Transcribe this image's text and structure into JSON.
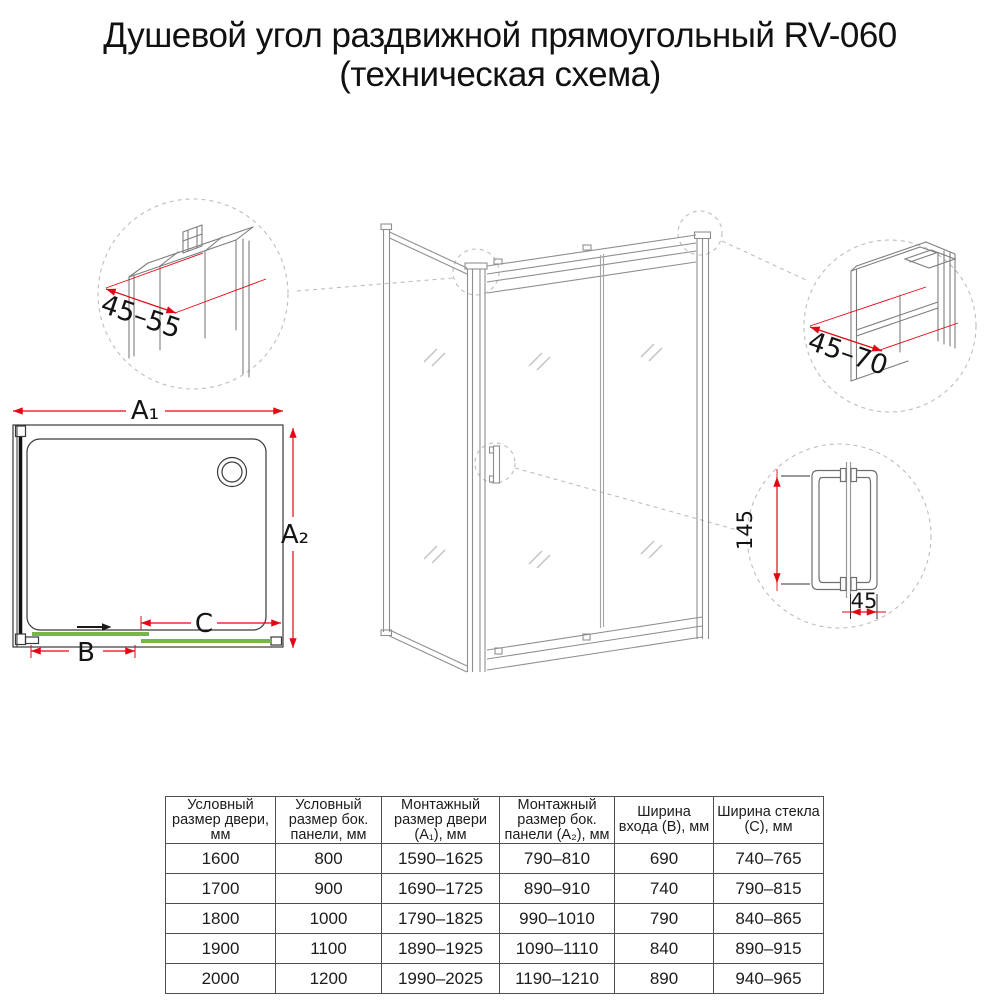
{
  "title": {
    "line1": "Душевой угол раздвижной прямоугольный RV-060",
    "line2": "(техническая схема)"
  },
  "diagram": {
    "plan_view": {
      "width_label": "A₁",
      "depth_label": "A₂",
      "door_label": "B",
      "glass_label": "C"
    },
    "details": {
      "wall_profile_adjust": "45–55",
      "door_profile_adjust": "45–70",
      "handle_length": "145",
      "handle_depth": "45"
    },
    "colors": {
      "dimension": "#e30613",
      "glass_panels": "#76b843"
    }
  },
  "table": {
    "headers": [
      "Условный размер двери, мм",
      "Условный размер бок. панели, мм",
      "Монтажный размер двери (A₁), мм",
      "Монтажный размер бок. панели (A₂), мм",
      "Ширина входа (B), мм",
      "Ширина стекла (C), мм"
    ],
    "rows": [
      [
        "1600",
        "800",
        "1590–1625",
        "790–810",
        "690",
        "740–765"
      ],
      [
        "1700",
        "900",
        "1690–1725",
        "890–910",
        "740",
        "790–815"
      ],
      [
        "1800",
        "1000",
        "1790–1825",
        "990–1010",
        "790",
        "840–865"
      ],
      [
        "1900",
        "1100",
        "1890–1925",
        "1090–1110",
        "840",
        "890–915"
      ],
      [
        "2000",
        "1200",
        "1990–2025",
        "1190–1210",
        "890",
        "940–965"
      ]
    ]
  }
}
